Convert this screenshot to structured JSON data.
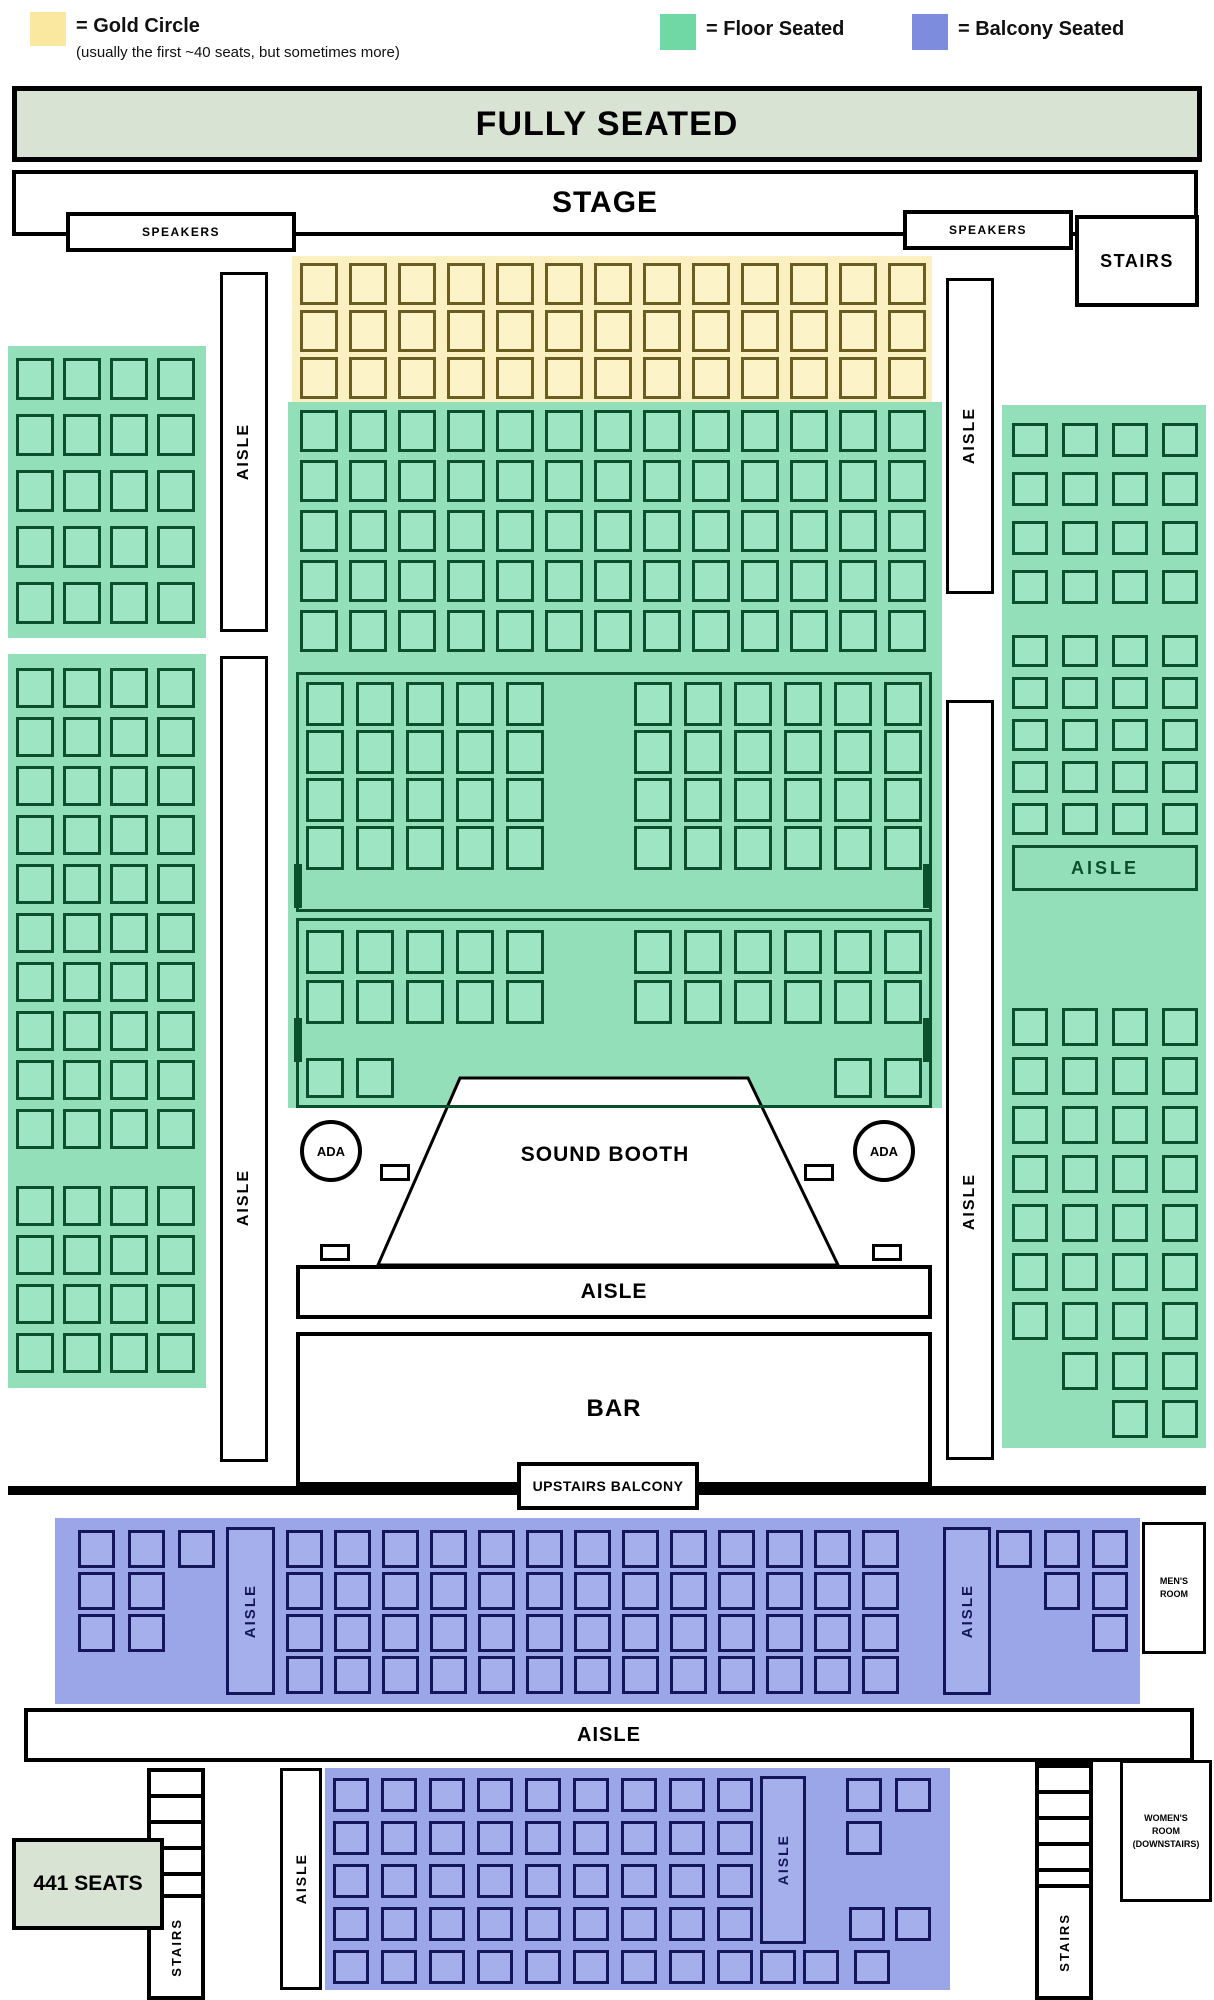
{
  "legend": {
    "items": [
      {
        "label": "= Gold Circle",
        "note": "(usually the first ~40 seats, but sometimes more)",
        "color": "#fae7a0"
      },
      {
        "label": "= Floor Seated",
        "color": "#70d8a5"
      },
      {
        "label": "= Balcony Seated",
        "color": "#7e8cdd"
      }
    ]
  },
  "banner": {
    "text": "FULLY SEATED"
  },
  "stage": {
    "label": "STAGE",
    "speakers_left": "SPEAKERS",
    "speakers_right": "SPEAKERS",
    "stairs_label": "STAIRS"
  },
  "labels": {
    "aisle": "AISLE",
    "sound_booth": "SOUND BOOTH",
    "ada": "ADA",
    "bar": "BAR",
    "upstairs_balcony": "UPSTAIRS BALCONY",
    "stairs": "STAIRS",
    "total": "441 SEATS"
  },
  "mens_room": {
    "line1": "MEN'S",
    "line2": "ROOM"
  },
  "womens_room": {
    "line1": "WOMEN'S",
    "line2": "ROOM",
    "line3": "(DOWNSTAIRS)"
  },
  "colors": {
    "gold_bg": "#faf0c1",
    "gold_seat": "#fcf3c8",
    "gold_border": "#6b5c1f",
    "green_bg": "#92dfb9",
    "green_seat": "#9ee5c3",
    "green_border": "#0b4f2c",
    "purple_bg": "#9aa6e8",
    "purple_seat": "#a4afeb",
    "purple_border": "#15155c",
    "sage": "#d8e3d4",
    "black": "#000000"
  },
  "seat_sections": [
    {
      "id": "gold-circle",
      "theme": "gold",
      "w": 38,
      "h": 42,
      "grid": {
        "x": 300,
        "y": 263,
        "cols": 13,
        "rows": 3,
        "dx": 49,
        "dy": 47
      }
    },
    {
      "id": "floor-front",
      "theme": "green",
      "w": 38,
      "h": 42,
      "grid": {
        "x": 300,
        "y": 410,
        "cols": 13,
        "rows": 5,
        "dx": 49,
        "dy": 50
      }
    },
    {
      "id": "floor-left-upper",
      "theme": "green",
      "w": 38,
      "h": 42,
      "grid": {
        "x": 16,
        "y": 358,
        "cols": 4,
        "rows": 5,
        "dx": 47,
        "dy": 56
      }
    },
    {
      "id": "floor-left-main",
      "theme": "green",
      "w": 38,
      "h": 40,
      "grid": {
        "x": 16,
        "y": 668,
        "cols": 4,
        "rows": 10,
        "dx": 47,
        "dy": 49
      }
    },
    {
      "id": "floor-left-rear",
      "theme": "green",
      "w": 38,
      "h": 40,
      "grid": {
        "x": 16,
        "y": 1186,
        "cols": 4,
        "rows": 4,
        "dx": 47,
        "dy": 49
      }
    },
    {
      "id": "floor-right-upper",
      "theme": "green",
      "w": 36,
      "h": 34,
      "grid": {
        "x": 1012,
        "y": 423,
        "cols": 4,
        "rows": 4,
        "dx": 50,
        "dy": 49
      }
    },
    {
      "id": "floor-right-mid",
      "theme": "green",
      "w": 36,
      "h": 32,
      "grid": {
        "x": 1012,
        "y": 635,
        "cols": 4,
        "rows": 5,
        "dx": 50,
        "dy": 42
      }
    },
    {
      "id": "floor-right-rear",
      "theme": "green",
      "w": 36,
      "h": 38,
      "grid": {
        "x": 1012,
        "y": 1008,
        "cols": 4,
        "rows": 7,
        "dx": 50,
        "dy": 49
      }
    },
    {
      "id": "floor-right-rear-b",
      "theme": "green",
      "w": 36,
      "h": 38,
      "grid": {
        "x": 1062,
        "y": 1352,
        "cols": 3,
        "rows": 1,
        "dx": 50,
        "dy": 0
      }
    },
    {
      "id": "floor-right-rear-c",
      "theme": "green",
      "w": 36,
      "h": 38,
      "grid": {
        "x": 1112,
        "y": 1400,
        "cols": 2,
        "rows": 1,
        "dx": 50,
        "dy": 0
      }
    },
    {
      "id": "center-box1-left",
      "theme": "green",
      "w": 38,
      "h": 44,
      "grid": {
        "x": 306,
        "y": 682,
        "cols": 5,
        "rows": 4,
        "dx": 50,
        "dy": 48
      }
    },
    {
      "id": "center-box1-right",
      "theme": "green",
      "w": 38,
      "h": 44,
      "grid": {
        "x": 634,
        "y": 682,
        "cols": 6,
        "rows": 4,
        "dx": 50,
        "dy": 48
      }
    },
    {
      "id": "center-box2-left",
      "theme": "green",
      "w": 38,
      "h": 44,
      "grid": {
        "x": 306,
        "y": 930,
        "cols": 5,
        "rows": 2,
        "dx": 50,
        "dy": 50
      }
    },
    {
      "id": "center-box2-right",
      "theme": "green",
      "w": 38,
      "h": 44,
      "grid": {
        "x": 634,
        "y": 930,
        "cols": 6,
        "rows": 2,
        "dx": 50,
        "dy": 50
      }
    },
    {
      "id": "center-box2-edge-left",
      "theme": "green",
      "w": 38,
      "h": 40,
      "grid": {
        "x": 306,
        "y": 1058,
        "cols": 2,
        "rows": 1,
        "dx": 50,
        "dy": 0
      }
    },
    {
      "id": "center-box2-edge-right",
      "theme": "green",
      "w": 38,
      "h": 40,
      "grid": {
        "x": 834,
        "y": 1058,
        "cols": 2,
        "rows": 1,
        "dx": 50,
        "dy": 0
      }
    },
    {
      "id": "balcony-upper-left",
      "theme": "purple",
      "w": 37,
      "h": 38,
      "seats": [
        [
          78,
          1530
        ],
        [
          128,
          1530
        ],
        [
          178,
          1530
        ],
        [
          78,
          1572
        ],
        [
          128,
          1572
        ],
        [
          78,
          1614
        ],
        [
          128,
          1614
        ]
      ]
    },
    {
      "id": "balcony-upper-mid",
      "theme": "purple",
      "w": 37,
      "h": 38,
      "grid": {
        "x": 286,
        "y": 1530,
        "cols": 13,
        "rows": 4,
        "dx": 48,
        "dy": 42
      }
    },
    {
      "id": "balcony-upper-right",
      "theme": "purple",
      "w": 36,
      "h": 38,
      "seats": [
        [
          996,
          1530
        ],
        [
          1044,
          1530
        ],
        [
          1092,
          1530
        ],
        [
          1044,
          1572
        ],
        [
          1092,
          1572
        ],
        [
          1092,
          1614
        ]
      ]
    },
    {
      "id": "balcony-lower-left",
      "theme": "purple",
      "w": 36,
      "h": 34,
      "grid": {
        "x": 333,
        "y": 1778,
        "cols": 9,
        "rows": 5,
        "dx": 48,
        "dy": 43
      }
    },
    {
      "id": "balcony-lower-right",
      "theme": "purple",
      "w": 36,
      "h": 34,
      "seats": [
        [
          846,
          1778
        ],
        [
          895,
          1778
        ],
        [
          846,
          1821
        ],
        [
          849,
          1907
        ],
        [
          895,
          1907
        ],
        [
          760,
          1950
        ],
        [
          803,
          1950
        ],
        [
          854,
          1950
        ]
      ]
    }
  ],
  "door_markers": [
    [
      294,
      864
    ],
    [
      923,
      864
    ],
    [
      294,
      1018
    ],
    [
      923,
      1018
    ]
  ],
  "ada_markers": [
    [
      380,
      1164
    ],
    [
      320,
      1244
    ],
    [
      804,
      1164
    ],
    [
      872,
      1244
    ]
  ]
}
